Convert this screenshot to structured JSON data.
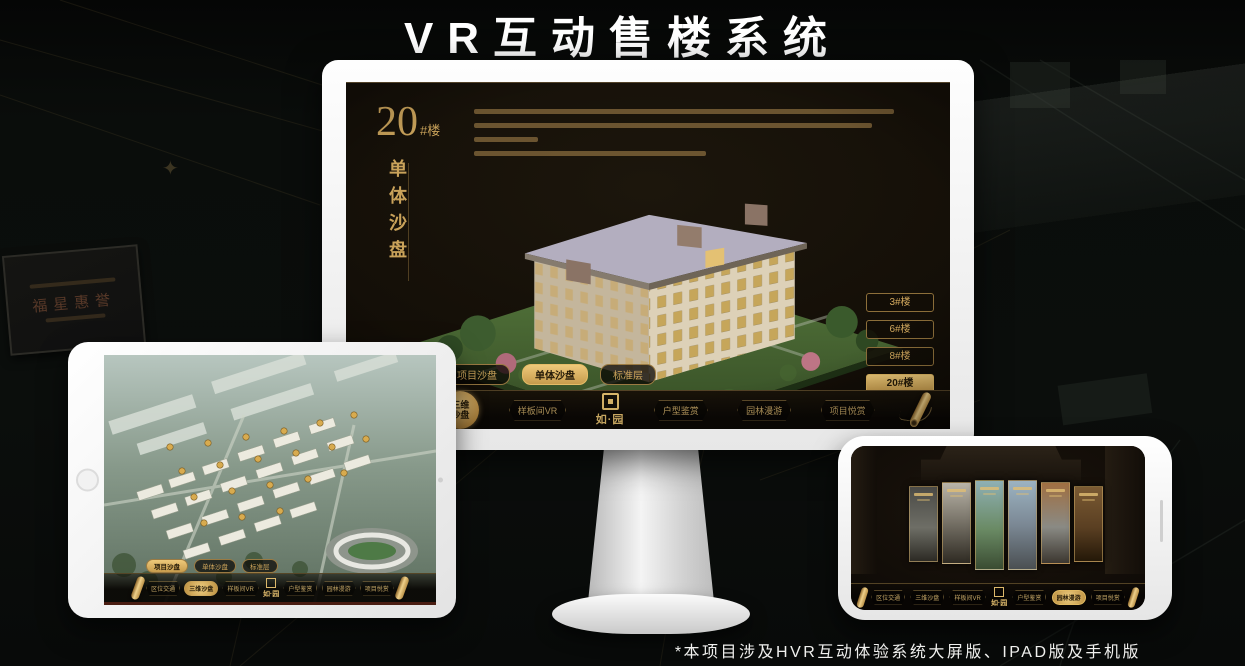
{
  "page": {
    "title": "VR互动售楼系统",
    "footnote": "*本项目涉及HVR互动体验系统大屏版、IPAD版及手机版"
  },
  "background": {
    "plaque_text": "福星惠誉"
  },
  "nav_menu": {
    "logo_text": "如·园",
    "items": [
      "区位交通",
      "三维沙盘",
      "样板间VR",
      "户型鉴赏",
      "园林漫游",
      "项目悦赏"
    ]
  },
  "monitor_app": {
    "headline_number": "20",
    "headline_unit": "#楼",
    "headline_subtitle": "单体沙盘",
    "nav_active_item": "三维沙盘",
    "building_buttons": [
      {
        "label": "3#楼",
        "active": false
      },
      {
        "label": "6#楼",
        "active": false
      },
      {
        "label": "8#楼",
        "active": false
      },
      {
        "label": "20#楼",
        "active": true
      }
    ],
    "view_tabs": [
      {
        "label": "项目沙盘",
        "active": false
      },
      {
        "label": "单体沙盘",
        "active": true
      },
      {
        "label": "标准层",
        "active": false
      }
    ]
  },
  "ipad_app": {
    "nav_active_item": "三维沙盘",
    "view_tabs": [
      {
        "label": "项目沙盘",
        "active": true
      },
      {
        "label": "单体沙盘",
        "active": false
      },
      {
        "label": "标准层",
        "active": false
      }
    ]
  },
  "phone_app": {
    "nav_active_item": "园林漫游"
  },
  "colors": {
    "gold": "#c9a25a",
    "gold_bright": "#eecd80",
    "screen_dark": "#130e07"
  }
}
